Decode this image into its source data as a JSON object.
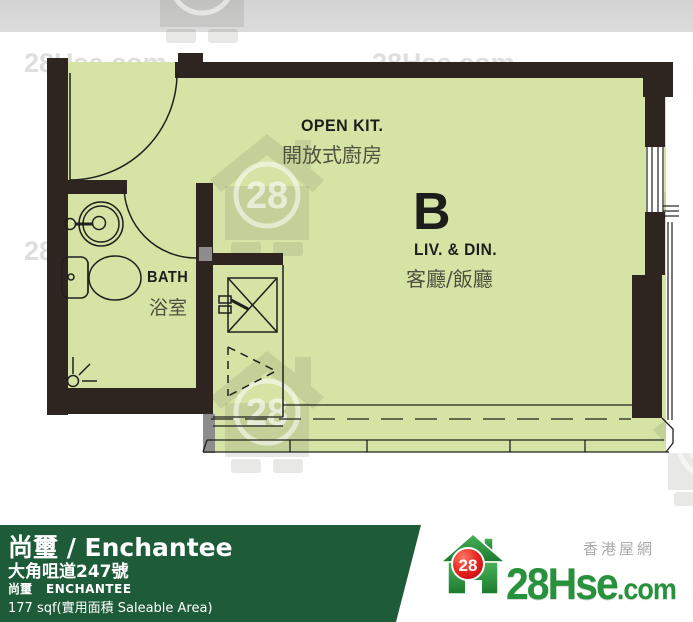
{
  "colors": {
    "floor_green": "#d5e3a5",
    "wall_dark": "#2e2420",
    "footer_bar_green": "#1e5b39",
    "top_band_gray": "#d8d8d8",
    "logo_green": "#27913c",
    "logo_red": "#d40018",
    "watermark_gray": "#d9d9d9"
  },
  "plan": {
    "unit_label": "B",
    "rooms": [
      {
        "name_en": "OPEN KIT.",
        "name_zh": "開放式廚房"
      },
      {
        "name_en": "LIV. & DIN.",
        "name_zh": "客廳/飯廳"
      },
      {
        "name_en": "BATH",
        "name_zh": "浴室"
      }
    ]
  },
  "watermark": {
    "text": "28Hse.com",
    "badge": "28"
  },
  "footer": {
    "title": "尚璽 / Enchantee",
    "address": "大角咀道247號",
    "estate_zh": "尚璽",
    "estate_en": "ENCHANTEE",
    "area": "177 sqf(實用面積 Saleable Area)"
  },
  "logo": {
    "badge": "28",
    "brand": "28Hse",
    "tld": ".com",
    "tagline": "香港屋網"
  }
}
